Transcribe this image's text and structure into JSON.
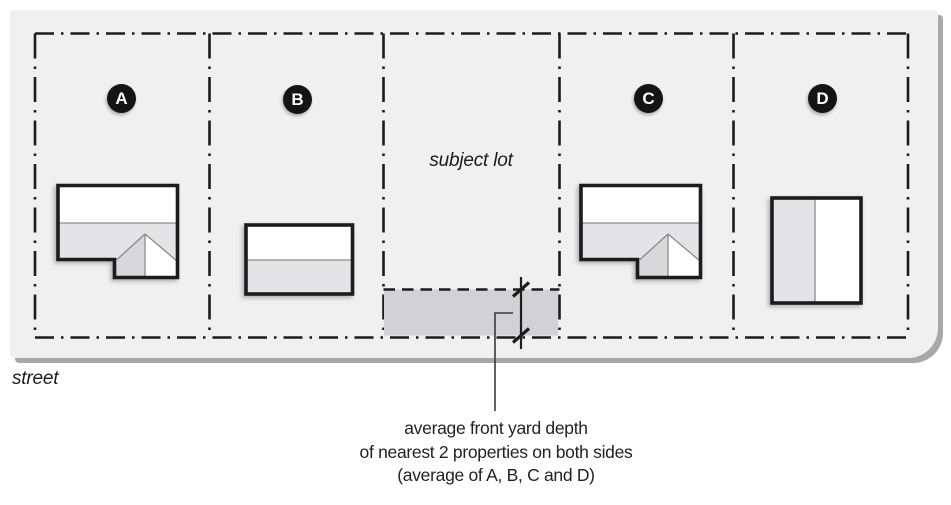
{
  "diagram": {
    "street_label": "street",
    "subject_lot_label": "subject lot",
    "lots": [
      {
        "label": "A"
      },
      {
        "label": "B"
      },
      {
        "label": "C"
      },
      {
        "label": "D"
      }
    ],
    "annotation_lines": [
      "average front yard depth",
      "of nearest 2 properties on both sides",
      "(average of A, B, C and D)"
    ],
    "colors": {
      "block_bg": "#f0f0f1",
      "block_shadow": "#a8a8a8",
      "line": "#1c1c1c",
      "house_gray": "#e4e4e6",
      "house_gray_dark": "#d8d8da",
      "yard_gray": "#d2d2d4",
      "white_fill": "#ffffff",
      "badge_bg": "#141414",
      "badge_text": "#ffffff",
      "leader": "#3a3a3a",
      "thin_line": "#8a8a8a"
    }
  }
}
